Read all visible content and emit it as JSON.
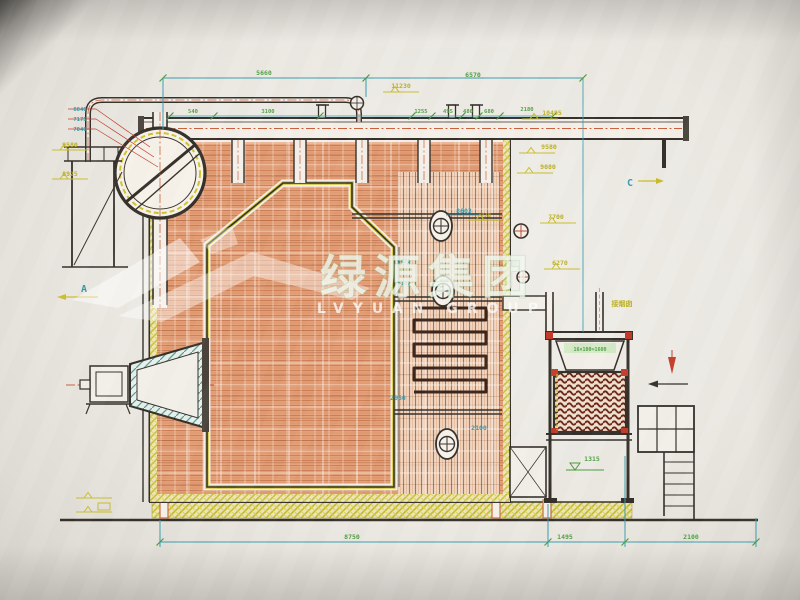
{
  "watermark": {
    "cn": "绿源集团",
    "en": "LVYUAN GROUP"
  },
  "colors": {
    "g": "#4a9c3f",
    "y": "#b9ad1c",
    "c": "#2f95a8"
  },
  "annotations": [
    {
      "n": "dim-5660",
      "t": "5660",
      "x": 264,
      "y": 75,
      "c": "g"
    },
    {
      "n": "dim-6570",
      "t": "6570",
      "x": 473,
      "y": 77,
      "c": "g"
    },
    {
      "n": "elev-11230",
      "t": "11230",
      "x": 401,
      "y": 88,
      "c": "y"
    },
    {
      "n": "dim-540",
      "t": "540",
      "x": 193,
      "y": 113,
      "c": "g",
      "s": 5.5
    },
    {
      "n": "dim-3100",
      "t": "3100",
      "x": 268,
      "y": 113,
      "c": "g",
      "s": 5.5
    },
    {
      "n": "dim-1255",
      "t": "1255",
      "x": 421,
      "y": 113,
      "c": "g",
      "s": 5.5
    },
    {
      "n": "dim-495",
      "t": "495",
      "x": 448,
      "y": 113,
      "c": "g",
      "s": 5.5
    },
    {
      "n": "dim-480",
      "t": "480",
      "x": 468,
      "y": 113,
      "c": "g",
      "s": 5.5
    },
    {
      "n": "dim-680",
      "t": "680",
      "x": 489,
      "y": 113,
      "c": "g",
      "s": 5.5
    },
    {
      "n": "dim-2180",
      "t": "2180",
      "x": 527,
      "y": 111,
      "c": "g",
      "s": 5.5
    },
    {
      "n": "elev-8840",
      "t": "8840",
      "x": 80,
      "y": 111,
      "c": "c",
      "s": 5.5
    },
    {
      "n": "elev-7175",
      "t": "7175",
      "x": 80,
      "y": 121,
      "c": "c",
      "s": 5.5
    },
    {
      "n": "elev-7040",
      "t": "7040",
      "x": 80,
      "y": 131,
      "c": "c",
      "s": 5.5
    },
    {
      "n": "elev-9580-left",
      "t": "9580",
      "x": 70,
      "y": 147,
      "c": "y"
    },
    {
      "n": "elev-8925",
      "t": "8925",
      "x": 70,
      "y": 176,
      "c": "y"
    },
    {
      "n": "section-a",
      "t": "A",
      "x": 84,
      "y": 292,
      "c": "c",
      "s": 10
    },
    {
      "n": "elev-10495",
      "t": "10495",
      "x": 552,
      "y": 115,
      "c": "y"
    },
    {
      "n": "elev-9580-right",
      "t": "9580",
      "x": 549,
      "y": 149,
      "c": "y"
    },
    {
      "n": "elev-9080",
      "t": "9080",
      "x": 548,
      "y": 169,
      "c": "y"
    },
    {
      "n": "elev-770",
      "t": "770",
      "x": 486,
      "y": 217,
      "c": "y",
      "s": 5.5
    },
    {
      "n": "elev-7700",
      "t": "7700",
      "x": 556,
      "y": 219,
      "c": "y"
    },
    {
      "n": "elev-6270",
      "t": "6270",
      "x": 560,
      "y": 265,
      "c": "y"
    },
    {
      "n": "section-c",
      "t": "C",
      "x": 630,
      "y": 186,
      "c": "c",
      "s": 10
    },
    {
      "n": "note-chimney",
      "t": "接烟囱",
      "x": 622,
      "y": 306,
      "c": "y",
      "s": 7
    },
    {
      "n": "eco-spec",
      "t": "16×100=1600",
      "x": 590,
      "y": 351,
      "c": "g",
      "s": 5
    },
    {
      "n": "dim-1315",
      "t": "1315",
      "x": 592,
      "y": 461,
      "c": "g"
    },
    {
      "n": "dim-8603",
      "t": "8603",
      "x": 464,
      "y": 213,
      "c": "c"
    },
    {
      "n": "dim-6620",
      "t": "6620",
      "x": 404,
      "y": 263,
      "c": "c",
      "s": 5.5
    },
    {
      "n": "dim-6107",
      "t": "6107",
      "x": 404,
      "y": 285,
      "c": "c",
      "s": 5.5
    },
    {
      "n": "dim-2960",
      "t": "2960",
      "x": 398,
      "y": 400,
      "c": "c"
    },
    {
      "n": "dim-2100-mid",
      "t": "2100",
      "x": 479,
      "y": 430,
      "c": "c"
    },
    {
      "n": "dim-8750",
      "t": "8750",
      "x": 352,
      "y": 539,
      "c": "g"
    },
    {
      "n": "dim-1495",
      "t": "1495",
      "x": 565,
      "y": 539,
      "c": "g"
    },
    {
      "n": "dim-2100",
      "t": "2100",
      "x": 691,
      "y": 539,
      "c": "g"
    }
  ]
}
